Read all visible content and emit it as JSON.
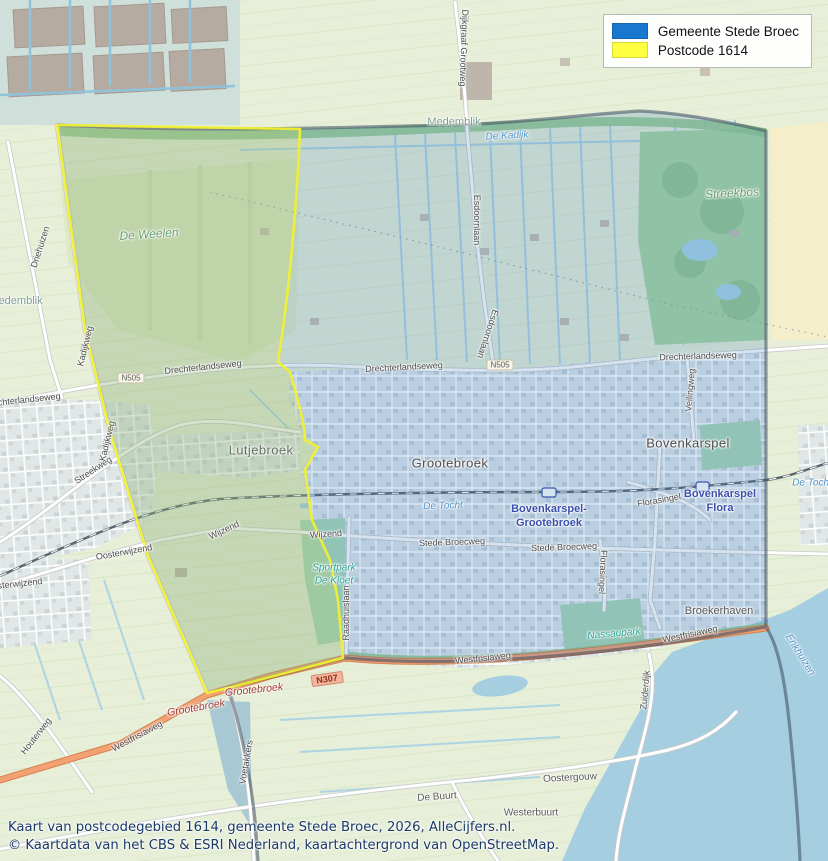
{
  "legend": {
    "items": [
      {
        "id": "gemeente",
        "label": "Gemeente Stede Broec",
        "color": "#1878d0"
      },
      {
        "id": "postcode",
        "label": "Postcode 1614",
        "color": "#ffff42"
      }
    ]
  },
  "caption": {
    "line1": "Kaart van postcodegebied 1614, gemeente Stede Broec, 2026, AlleCijfers.nl.",
    "line2": "© Kaartdata van het CBS & ESRI Nederland, kaartachtergrond van OpenStreetMap."
  },
  "colors": {
    "municipality_fill": "rgba(45,115,185,0.20)",
    "municipality_border": "#3e4c60",
    "postcode_fill": "rgba(250,250,60,0.22)",
    "postcode_border": "#eff032",
    "water": "#a5cee0",
    "orange_road": "#f2a173",
    "caption_text": "#1b3a66"
  },
  "map": {
    "labels": [
      {
        "t": "Grootebroek",
        "x": 450,
        "y": 463,
        "r": 0,
        "k": "town"
      },
      {
        "t": "Bovenkarspel",
        "x": 688,
        "y": 443,
        "r": 0,
        "k": "town"
      },
      {
        "t": "Lutjebroek",
        "x": 261,
        "y": 450,
        "r": 0,
        "k": "town-muted"
      },
      {
        "t": "Broekerhaven",
        "x": 719,
        "y": 611,
        "r": 0,
        "k": "town-small"
      },
      {
        "t": "Medemblik",
        "x": 454,
        "y": 122,
        "r": 0,
        "k": "area"
      },
      {
        "t": "Medemblik",
        "x": 16,
        "y": 301,
        "r": 0,
        "k": "area"
      },
      {
        "t": "Oostergouw",
        "x": 570,
        "y": 778,
        "r": -3,
        "k": "hamlet"
      },
      {
        "t": "De Buurt",
        "x": 437,
        "y": 797,
        "r": -4,
        "k": "hamlet"
      },
      {
        "t": "Westerbuurt",
        "x": 531,
        "y": 813,
        "r": 0,
        "k": "hamlet"
      },
      {
        "t": "Bovenkarspel-",
        "x": 549,
        "y": 509,
        "r": 0,
        "k": "station"
      },
      {
        "t": "Grootebroek",
        "x": 549,
        "y": 523,
        "r": 0,
        "k": "station"
      },
      {
        "t": "Bovenkarspel",
        "x": 720,
        "y": 494,
        "r": 0,
        "k": "station"
      },
      {
        "t": "Flora",
        "x": 720,
        "y": 508,
        "r": 0,
        "k": "station"
      },
      {
        "t": "De Tocht",
        "x": 443,
        "y": 506,
        "r": -2,
        "k": "water"
      },
      {
        "t": "De Tocht",
        "x": 812,
        "y": 483,
        "r": 0,
        "k": "water"
      },
      {
        "t": "De Kadijk",
        "x": 507,
        "y": 136,
        "r": -3,
        "k": "water"
      },
      {
        "t": "Enkhuizen",
        "x": 800,
        "y": 655,
        "r": 58,
        "k": "water"
      },
      {
        "t": "De Weelen",
        "x": 149,
        "y": 234,
        "r": -4,
        "k": "green"
      },
      {
        "t": "Streekbos",
        "x": 732,
        "y": 193,
        "r": -3,
        "k": "green"
      },
      {
        "t": "Sportpark",
        "x": 334,
        "y": 568,
        "r": 0,
        "k": "park"
      },
      {
        "t": "De Kloet",
        "x": 334,
        "y": 581,
        "r": 0,
        "k": "park"
      },
      {
        "t": "Nassaupark",
        "x": 614,
        "y": 634,
        "r": -5,
        "k": "park"
      },
      {
        "t": "Drechterlandseweg",
        "x": 404,
        "y": 367,
        "r": -3,
        "k": "road"
      },
      {
        "t": "Drechterlandseweg",
        "x": 698,
        "y": 356,
        "r": -2,
        "k": "road"
      },
      {
        "t": "Drechterlandseweg",
        "x": 203,
        "y": 367,
        "r": -6,
        "k": "road"
      },
      {
        "t": "Drechterlandseweg",
        "x": 22,
        "y": 400,
        "r": -6,
        "k": "road"
      },
      {
        "t": "Streekweg",
        "x": 93,
        "y": 470,
        "r": -33,
        "k": "road"
      },
      {
        "t": "Stede Broecweg",
        "x": 452,
        "y": 542,
        "r": -2,
        "k": "road"
      },
      {
        "t": "Stede Broecweg",
        "x": 564,
        "y": 547,
        "r": -2,
        "k": "road"
      },
      {
        "t": "Wijzend",
        "x": 326,
        "y": 534,
        "r": -4,
        "k": "road"
      },
      {
        "t": "Wijzend",
        "x": 224,
        "y": 530,
        "r": -25,
        "k": "road"
      },
      {
        "t": "Oosterwijzend",
        "x": 124,
        "y": 552,
        "r": -10,
        "k": "road"
      },
      {
        "t": "Oosterwijzend",
        "x": 14,
        "y": 584,
        "r": -6,
        "k": "road"
      },
      {
        "t": "Westfrisiaweg",
        "x": 137,
        "y": 736,
        "r": -28,
        "k": "road"
      },
      {
        "t": "Westfrisiaweg",
        "x": 483,
        "y": 658,
        "r": -6,
        "k": "road"
      },
      {
        "t": "Westfrisiaweg",
        "x": 690,
        "y": 634,
        "r": -12,
        "k": "road"
      },
      {
        "t": "Raadhuislaan",
        "x": 346,
        "y": 613,
        "r": -90,
        "k": "road"
      },
      {
        "t": "Esdoornlaan",
        "x": 477,
        "y": 220,
        "r": 90,
        "k": "road"
      },
      {
        "t": "Esdoornlaan",
        "x": 488,
        "y": 334,
        "r": 108,
        "k": "road"
      },
      {
        "t": "Dijkgraaf Grootweg",
        "x": 464,
        "y": 48,
        "r": 92,
        "k": "road"
      },
      {
        "t": "Kadijkweg",
        "x": 85,
        "y": 346,
        "r": -76,
        "k": "road"
      },
      {
        "t": "Kadijkweg",
        "x": 107,
        "y": 441,
        "r": -76,
        "k": "road"
      },
      {
        "t": "Driehuizen",
        "x": 40,
        "y": 247,
        "r": -72,
        "k": "road"
      },
      {
        "t": "Houterweg",
        "x": 36,
        "y": 736,
        "r": -52,
        "k": "road"
      },
      {
        "t": "Voetakkers",
        "x": 246,
        "y": 762,
        "r": -80,
        "k": "road"
      },
      {
        "t": "Zuiderdijk",
        "x": 645,
        "y": 690,
        "r": -85,
        "k": "road"
      },
      {
        "t": "Florasingel",
        "x": 659,
        "y": 500,
        "r": -10,
        "k": "road"
      },
      {
        "t": "Florasingel",
        "x": 603,
        "y": 572,
        "r": 93,
        "k": "road"
      },
      {
        "t": "Veilingweg",
        "x": 690,
        "y": 390,
        "r": -85,
        "k": "road"
      },
      {
        "t": "N505",
        "x": 131,
        "y": 378,
        "r": 0,
        "k": "shield505"
      },
      {
        "t": "N505",
        "x": 500,
        "y": 365,
        "r": 0,
        "k": "shield505"
      },
      {
        "t": "N307",
        "x": 327,
        "y": 679,
        "r": -8,
        "k": "shield307"
      },
      {
        "t": "Grootebroek",
        "x": 196,
        "y": 708,
        "r": -10,
        "k": "roadred"
      },
      {
        "t": "Grootebroek",
        "x": 254,
        "y": 690,
        "r": -6,
        "k": "roadred"
      }
    ]
  }
}
